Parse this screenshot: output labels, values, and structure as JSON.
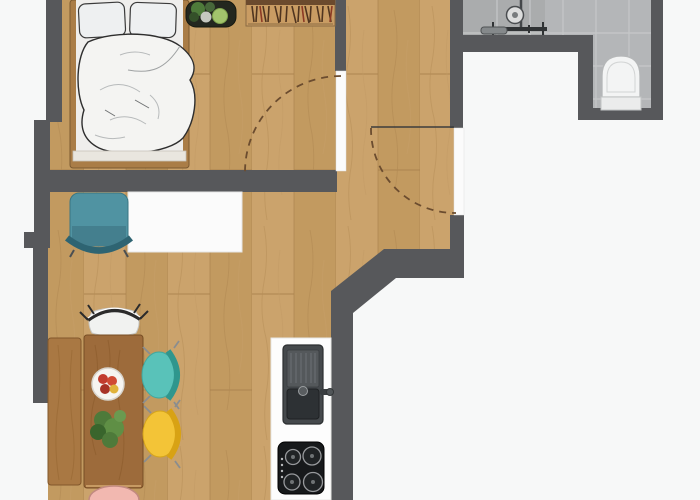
{
  "image": {
    "type": "apartment-floor-plan",
    "width": 700,
    "height": 500,
    "orientation": "top-down"
  },
  "palette": {
    "void": "#f7f8f8",
    "wall": "#57585b",
    "floor_wood": "#cba36c",
    "floor_wood_alt": "#c29a60",
    "tile": "#b4b6b8",
    "tile_shower": "#a9abac",
    "tile_grout": "#c6c8c9",
    "counter": "#fdfdfd",
    "desk": "#fbfbfb",
    "bed_frame": "#aa7d47",
    "mattress": "#efeeec",
    "bedding": "#f4f4f2",
    "footboard": "#e9e6df",
    "rack_wood": "#c99c63",
    "side_table": "#23271f",
    "plant_green": "#4e7a3a",
    "plant_light": "#a2c46c",
    "desk_chair_teal": "#5093a2",
    "dining_table": "#9d6b3b",
    "bench": "#a97843",
    "chair_white": "#f1f2f0",
    "chair_teal": "#59c2b9",
    "chair_yellow": "#f3c437",
    "chair_pink": "#f2b8b0",
    "fruit_red": "#c23b2e",
    "sink": "#45494c",
    "sink_basin": "#2d3134",
    "cooktop": "#17191b",
    "toilet": "#f3f4f4",
    "shower_metal": "#303335",
    "door_arc": "#6b4c2f",
    "door_leaf": "#3c3c3c",
    "opening_white": "#fbfbfb"
  },
  "rooms": [
    {
      "name": "bedroom",
      "floor": "wood",
      "furniture": [
        "double-bed",
        "pillows",
        "duvet",
        "plant-side-table",
        "clothes-rack"
      ]
    },
    {
      "name": "living-area",
      "floor": "wood",
      "furniture": [
        "desk",
        "desk-chair"
      ]
    },
    {
      "name": "dining-area",
      "floor": "wood",
      "furniture": [
        "dining-table",
        "bench",
        "chair-white",
        "chair-teal",
        "chair-yellow",
        "chair-pink",
        "fruit-bowl",
        "table-plant"
      ]
    },
    {
      "name": "kitchen",
      "floor": "wood",
      "furniture": [
        "counter",
        "sink",
        "cooktop"
      ]
    },
    {
      "name": "bathroom",
      "floor": "tile",
      "furniture": [
        "shower",
        "toilet"
      ]
    }
  ],
  "doors": [
    {
      "name": "entry-door",
      "type": "swing",
      "location": "right-wall"
    },
    {
      "name": "bedroom-door",
      "type": "swing",
      "location": "bedroom-partition"
    }
  ]
}
